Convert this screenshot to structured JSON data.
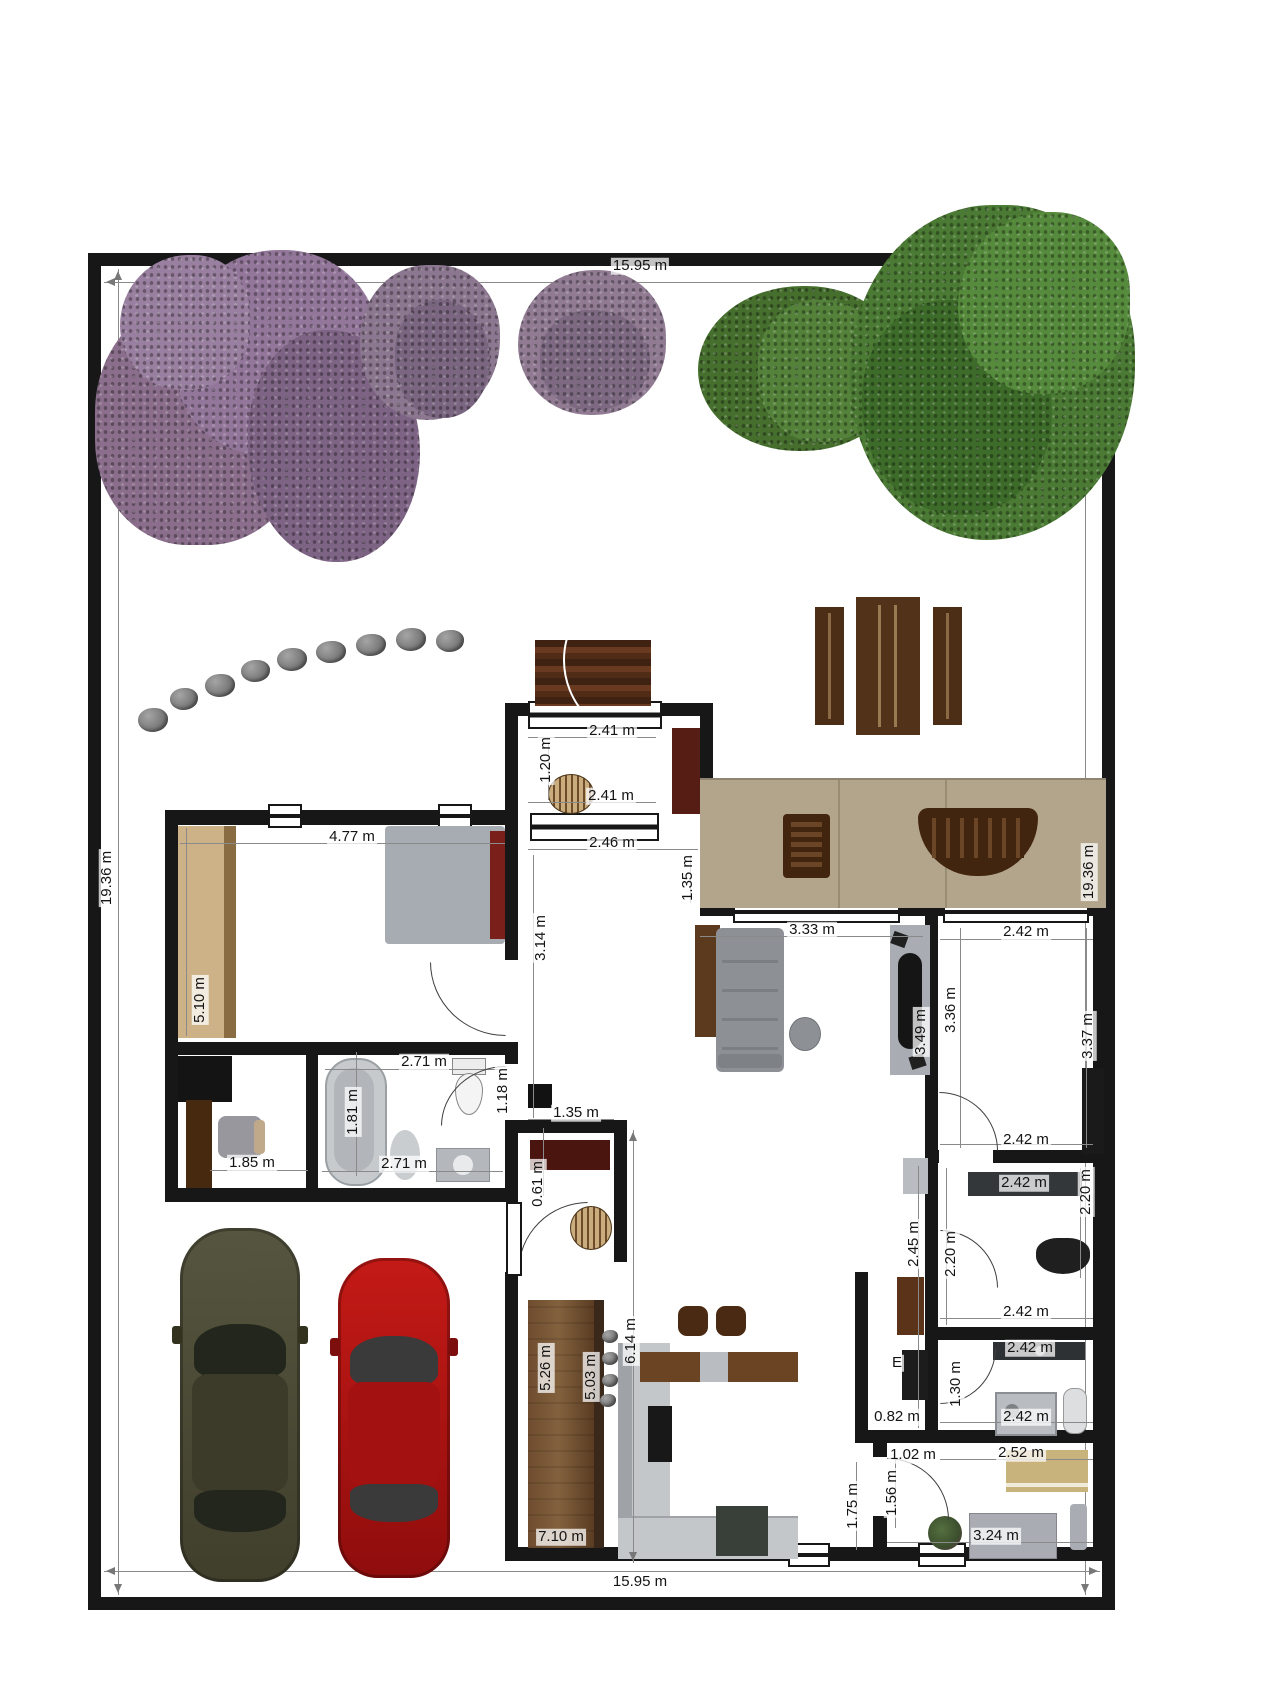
{
  "site": {
    "width_label": "15.95 m",
    "height_label": "19.36 m"
  },
  "dim_labels": [
    {
      "text": "15.95 m",
      "x": 640,
      "y": 266
    },
    {
      "text": "19.36 m",
      "x": 107,
      "y": 878,
      "rot": 1
    },
    {
      "text": "19.36 m",
      "x": 1089,
      "y": 872,
      "rot": 1
    },
    {
      "text": "15.95 m",
      "x": 640,
      "y": 1582
    },
    {
      "text": "2.41 m",
      "x": 612,
      "y": 731
    },
    {
      "text": "1.20 m",
      "x": 546,
      "y": 760,
      "rot": 1
    },
    {
      "text": "2.41 m",
      "x": 611,
      "y": 796
    },
    {
      "text": "2.46 m",
      "x": 612,
      "y": 843
    },
    {
      "text": "1.35 m",
      "x": 688,
      "y": 878,
      "rot": 1
    },
    {
      "text": "3.14 m",
      "x": 541,
      "y": 938,
      "rot": 1
    },
    {
      "text": "4.77 m",
      "x": 352,
      "y": 837
    },
    {
      "text": "5.10 m",
      "x": 200,
      "y": 1000,
      "rot": 1
    },
    {
      "text": "1.85 m",
      "x": 252,
      "y": 1163
    },
    {
      "text": "2.71 m",
      "x": 424,
      "y": 1062
    },
    {
      "text": "1.81 m",
      "x": 353,
      "y": 1112,
      "rot": 1
    },
    {
      "text": "2.71 m",
      "x": 404,
      "y": 1164
    },
    {
      "text": "1.18 m",
      "x": 503,
      "y": 1091,
      "rot": 1
    },
    {
      "text": "1.35 m",
      "x": 576,
      "y": 1113
    },
    {
      "text": "0.61 m",
      "x": 538,
      "y": 1184,
      "rot": 1
    },
    {
      "text": "3.33 m",
      "x": 812,
      "y": 930
    },
    {
      "text": "3.49 m",
      "x": 921,
      "y": 1032,
      "rot": 1
    },
    {
      "text": "2.42 m",
      "x": 1026,
      "y": 932
    },
    {
      "text": "3.36 m",
      "x": 951,
      "y": 1010,
      "rot": 1
    },
    {
      "text": "3.37 m",
      "x": 1088,
      "y": 1036,
      "rot": 1
    },
    {
      "text": "2.42 m",
      "x": 1026,
      "y": 1140
    },
    {
      "text": "2.42 m",
      "x": 1024,
      "y": 1183
    },
    {
      "text": "2.20 m",
      "x": 951,
      "y": 1254,
      "rot": 1
    },
    {
      "text": "2.20 m",
      "x": 1086,
      "y": 1192,
      "rot": 1
    },
    {
      "text": "2.42 m",
      "x": 1026,
      "y": 1312
    },
    {
      "text": "2.42 m",
      "x": 1030,
      "y": 1348
    },
    {
      "text": "1.30 m",
      "x": 956,
      "y": 1384,
      "rot": 1
    },
    {
      "text": "2.42 m",
      "x": 1026,
      "y": 1417
    },
    {
      "text": "2.45 m",
      "x": 914,
      "y": 1244,
      "rot": 1
    },
    {
      "text": "0.82 m",
      "x": 897,
      "y": 1417
    },
    {
      "text": "2.52 m",
      "x": 1021,
      "y": 1453
    },
    {
      "text": "1.02 m",
      "x": 913,
      "y": 1455
    },
    {
      "text": "1.56 m",
      "x": 892,
      "y": 1493,
      "rot": 1
    },
    {
      "text": "3.24 m",
      "x": 996,
      "y": 1536
    },
    {
      "text": "1.75 m",
      "x": 853,
      "y": 1506,
      "rot": 1
    },
    {
      "text": "6.14 m",
      "x": 631,
      "y": 1341,
      "rot": 1
    },
    {
      "text": "5.26 m",
      "x": 546,
      "y": 1368,
      "rot": 1
    },
    {
      "text": "5.03 m",
      "x": 591,
      "y": 1377,
      "rot": 1
    },
    {
      "text": "7.10 m",
      "x": 561,
      "y": 1537
    },
    {
      "text": "E",
      "x": 897,
      "y": 1363
    }
  ],
  "colors": {
    "wall": "#171717",
    "deck": "#b3a58b",
    "outdoor_wood": "#4c2d15",
    "foliage_purple": "#8a6e8c",
    "foliage_green": "#4a7a33",
    "car_olive": "#4b4a39",
    "car_red": "#b01315",
    "counter_gray": "#b9bdc1",
    "wardrobe_tan": "#cdb287",
    "headboard_red": "#7a1f1a"
  }
}
